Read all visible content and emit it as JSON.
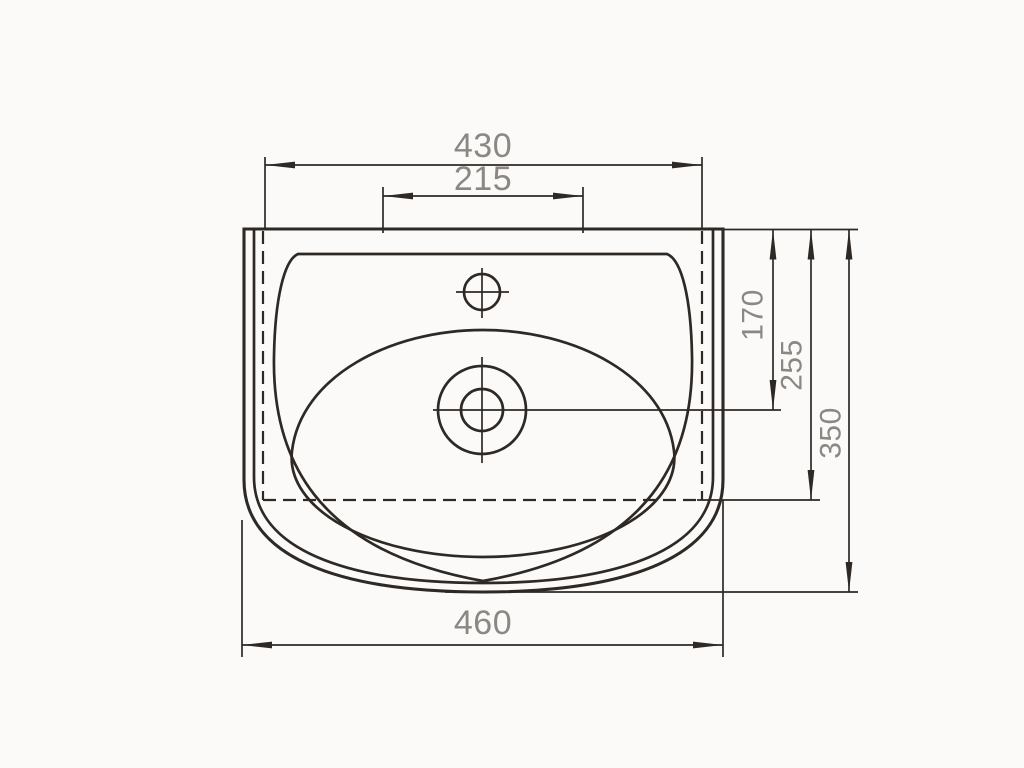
{
  "drawing": {
    "title": "Washbasin top-view dimension drawing",
    "view": "top view",
    "dimensions": {
      "body_width": "430",
      "tap_span": "215",
      "drain_offset": "170",
      "hidden_body_depth": "255",
      "overall_depth": "350",
      "overall_width": "460"
    },
    "colors": {
      "line": "#2e2924",
      "dim_text": "#8b8782",
      "background": "#fbfaf9"
    }
  }
}
